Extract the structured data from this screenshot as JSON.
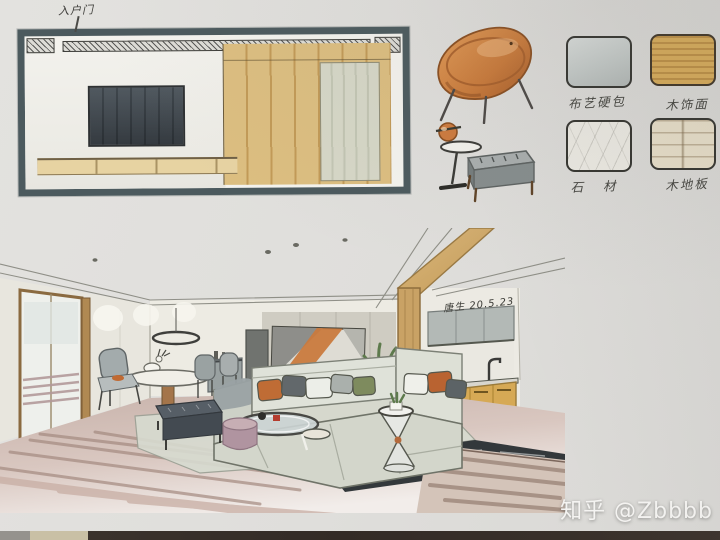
{
  "page": {
    "description": "Photographed hand-drawn marker rendering of a living/dining room interior design presentation board",
    "paper_color": "#e0dfdc"
  },
  "annotations": {
    "elevation_label": "入户门",
    "signature": "唐生 20.5.23"
  },
  "materials": {
    "items": [
      {
        "label": "布艺硬包",
        "color": "#c6ccc9"
      },
      {
        "label": "木饰面",
        "color": "#d9ac58"
      },
      {
        "label": "石  材",
        "color": "#edebe4"
      },
      {
        "label": "木地板",
        "color": "#e9e0ca"
      }
    ]
  },
  "watermark": {
    "text": "知乎 @Zbbbb",
    "color": "#f5f4f2"
  },
  "palette": {
    "elevation_frame": "#4c5a5e",
    "tv_screen": "#545a5e",
    "wood_veneer": "#d9b873",
    "saucer_chair_orange": "#cd7a3e",
    "sofa_gray": "#d7dad0",
    "pillow_orange": "#bf6a33",
    "floor_mauve": "#c3a89f",
    "ottoman_dark": "#4e555c",
    "rug_green_gray": "#d7dbd0",
    "stone_band_dark": "#33383b"
  }
}
